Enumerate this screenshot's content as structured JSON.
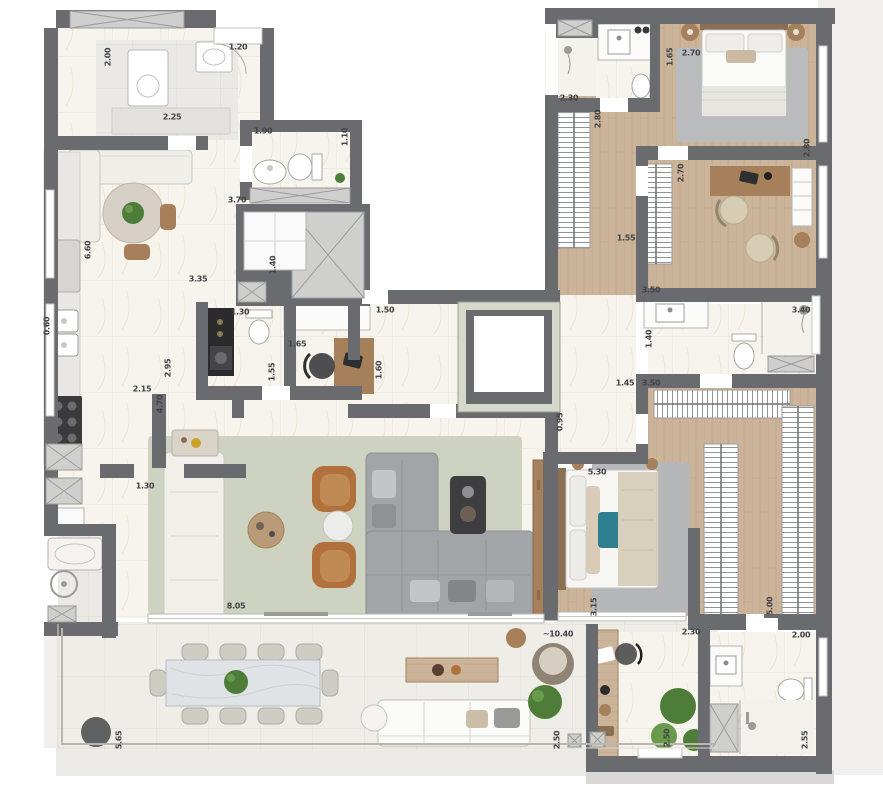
{
  "colors": {
    "wall": "#6a6b6e",
    "marble": "#f7f4ee",
    "tile_line": "#ddd2c1",
    "gray_tile": "#eae9e5",
    "gray_tile_line": "#d6d4cf",
    "wood": "#cbb49a",
    "wood_line": "#b2977a",
    "wood_dark": "#a5805a",
    "terrace": "#efede7",
    "terrace_line": "#dcd9d1",
    "rug_living": "#cdd3c0",
    "rug_gray": "#b9bbbc",
    "sofa_gray": "#a2a5a8",
    "sofa_gray_line": "#8d9093",
    "armchair_tan": "#b0713c",
    "accent_teal": "#2e7f8f",
    "plant_green": "#4e7d3a",
    "plant_green_light": "#6a9a4c",
    "shaft_fill": "#cfcfcd",
    "shaft_line": "#9b9b99",
    "fixture_white": "#fbfbf9",
    "fixture_line": "#b5b5b2",
    "counter": "#e9e7e3",
    "black_counter": "#2b2b2d",
    "label_color": "#414347"
  },
  "floor_plan": {
    "dimension_labels": [
      {
        "value": "2.00",
        "x": 108,
        "y": 57,
        "vertical": true
      },
      {
        "value": "2.25",
        "x": 172,
        "y": 117,
        "vertical": false
      },
      {
        "value": "1.20",
        "x": 238,
        "y": 47,
        "vertical": false
      },
      {
        "value": "1.90",
        "x": 263,
        "y": 131,
        "vertical": false
      },
      {
        "value": "1.10",
        "x": 345,
        "y": 137,
        "vertical": true
      },
      {
        "value": "3.70",
        "x": 237,
        "y": 200,
        "vertical": false
      },
      {
        "value": "6.60",
        "x": 88,
        "y": 250,
        "vertical": true
      },
      {
        "value": "0.60",
        "x": 47,
        "y": 326,
        "vertical": true
      },
      {
        "value": "3.35",
        "x": 198,
        "y": 279,
        "vertical": false
      },
      {
        "value": "1.30",
        "x": 240,
        "y": 312,
        "vertical": false
      },
      {
        "value": "1.65",
        "x": 297,
        "y": 344,
        "vertical": false
      },
      {
        "value": "1.55",
        "x": 272,
        "y": 372,
        "vertical": true
      },
      {
        "value": "2.95",
        "x": 168,
        "y": 368,
        "vertical": true
      },
      {
        "value": "2.15",
        "x": 142,
        "y": 389,
        "vertical": false
      },
      {
        "value": "4.70",
        "x": 160,
        "y": 404,
        "vertical": true
      },
      {
        "value": "1.40",
        "x": 273,
        "y": 265,
        "vertical": true
      },
      {
        "value": "1.30",
        "x": 145,
        "y": 486,
        "vertical": false
      },
      {
        "value": "1.50",
        "x": 385,
        "y": 310,
        "vertical": false
      },
      {
        "value": "1.60",
        "x": 379,
        "y": 370,
        "vertical": true
      },
      {
        "value": "0.95",
        "x": 560,
        "y": 422,
        "vertical": true
      },
      {
        "value": "1.45",
        "x": 625,
        "y": 383,
        "vertical": false
      },
      {
        "value": "3.50",
        "x": 651,
        "y": 383,
        "vertical": false
      },
      {
        "value": "2.30",
        "x": 569,
        "y": 98,
        "vertical": false
      },
      {
        "value": "2.70",
        "x": 691,
        "y": 53,
        "vertical": false
      },
      {
        "value": "1.65",
        "x": 670,
        "y": 57,
        "vertical": true
      },
      {
        "value": "2.80",
        "x": 598,
        "y": 119,
        "vertical": true
      },
      {
        "value": "2.80",
        "x": 807,
        "y": 148,
        "vertical": true
      },
      {
        "value": "2.70",
        "x": 681,
        "y": 173,
        "vertical": true
      },
      {
        "value": "1.55",
        "x": 626,
        "y": 238,
        "vertical": false
      },
      {
        "value": "3.50",
        "x": 651,
        "y": 290,
        "vertical": false
      },
      {
        "value": "3.40",
        "x": 801,
        "y": 310,
        "vertical": false
      },
      {
        "value": "1.40",
        "x": 649,
        "y": 339,
        "vertical": true
      },
      {
        "value": "5.30",
        "x": 597,
        "y": 472,
        "vertical": false
      },
      {
        "value": "3.15",
        "x": 594,
        "y": 607,
        "vertical": true
      },
      {
        "value": "5.00",
        "x": 770,
        "y": 606,
        "vertical": true
      },
      {
        "value": "2.30",
        "x": 691,
        "y": 632,
        "vertical": false
      },
      {
        "value": "2.00",
        "x": 801,
        "y": 635,
        "vertical": false
      },
      {
        "value": "2.50",
        "x": 667,
        "y": 738,
        "vertical": true
      },
      {
        "value": "2.55",
        "x": 805,
        "y": 740,
        "vertical": true
      },
      {
        "value": "8.05",
        "x": 236,
        "y": 606,
        "vertical": false
      },
      {
        "value": "5.65",
        "x": 119,
        "y": 740,
        "vertical": true
      },
      {
        "value": "~10.40",
        "x": 558,
        "y": 634,
        "vertical": false
      },
      {
        "value": "2.50",
        "x": 557,
        "y": 740,
        "vertical": true
      }
    ]
  }
}
